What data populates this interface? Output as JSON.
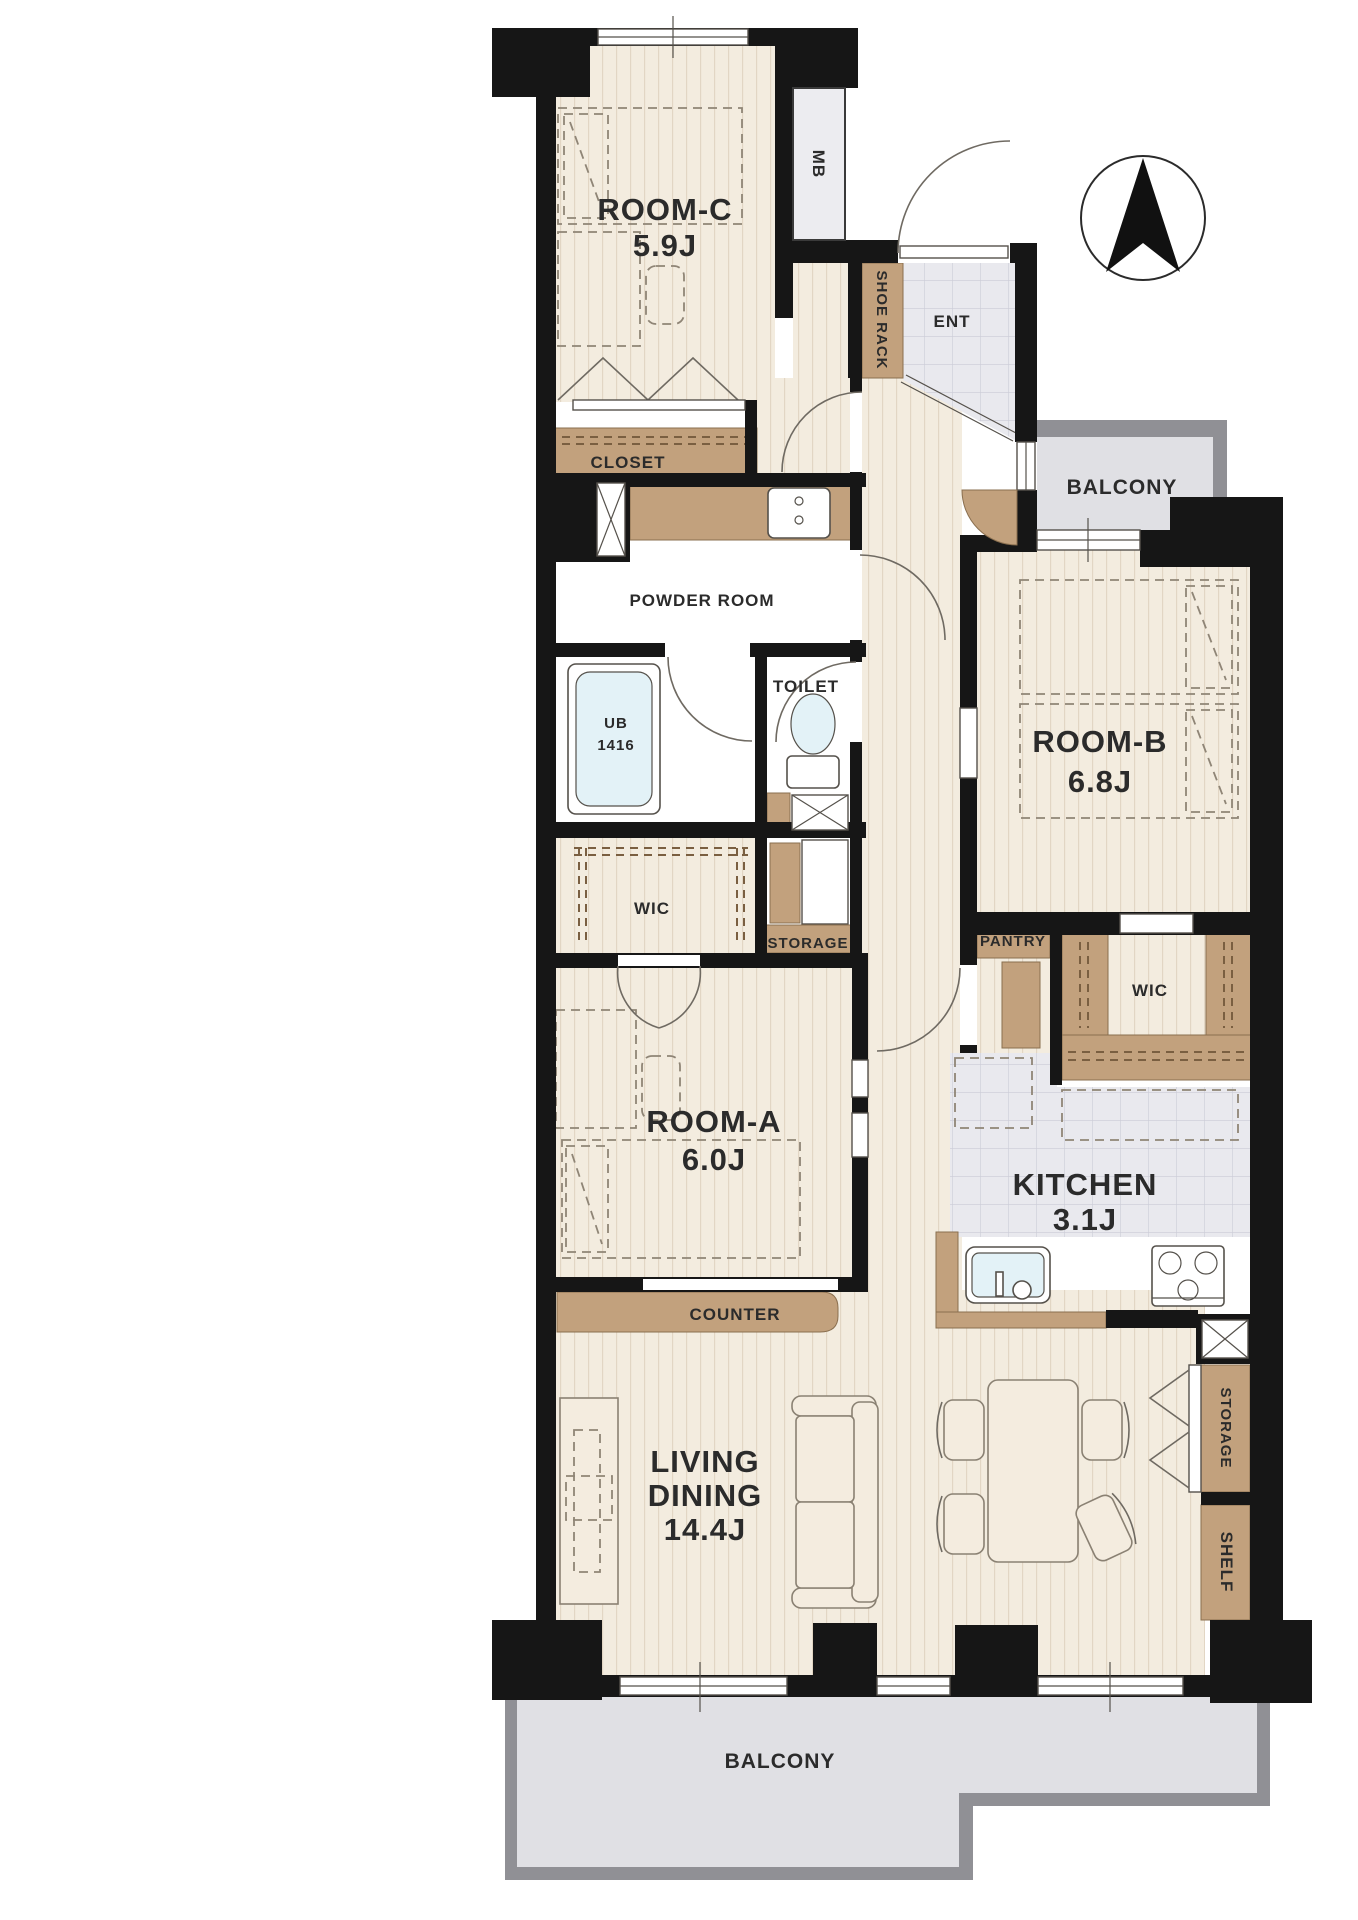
{
  "title": "Apartment floor plan",
  "compass": {
    "icon": "north-arrow"
  },
  "rooms": [
    {
      "id": "room-c",
      "name": "ROOM-C",
      "area": "5.9J"
    },
    {
      "id": "room-b",
      "name": "ROOM-B",
      "area": "6.8J"
    },
    {
      "id": "room-a",
      "name": "ROOM-A",
      "area": "6.0J"
    },
    {
      "id": "living-dining",
      "name": "LIVING",
      "name2": "DINING",
      "area": "14.4J"
    },
    {
      "id": "kitchen",
      "name": "KITCHEN",
      "area": "3.1J"
    }
  ],
  "labels": {
    "mb": "MB",
    "shoe_rack": "SHOE RACK",
    "ent": "ENT",
    "closet": "CLOSET",
    "powder_room": "POWDER ROOM",
    "toilet": "TOILET",
    "ub_line1": "UB",
    "ub_line2": "1416",
    "wic_a": "WIC",
    "storage_a": "STORAGE",
    "pantry": "PANTRY",
    "wic_b": "WIC",
    "counter": "COUNTER",
    "storage_b": "STORAGE",
    "shelf": "SHELF",
    "balcony_right": "BALCONY",
    "balcony_bottom": "BALCONY"
  },
  "colors": {
    "wall": "#161616",
    "wood_floor": "#f3ecdf",
    "wood_stripe": "#e2d6c4",
    "tile": "#e9e9ee",
    "tile_line": "#cbccd6",
    "cabinet_brown": "#c2a17d",
    "cabinet_line": "#8a6f4f",
    "balcony": "#e0e0e4",
    "balcony_border": "#909095",
    "fixture_blue": "#e3f2f7",
    "text": "#2b2b2b"
  }
}
